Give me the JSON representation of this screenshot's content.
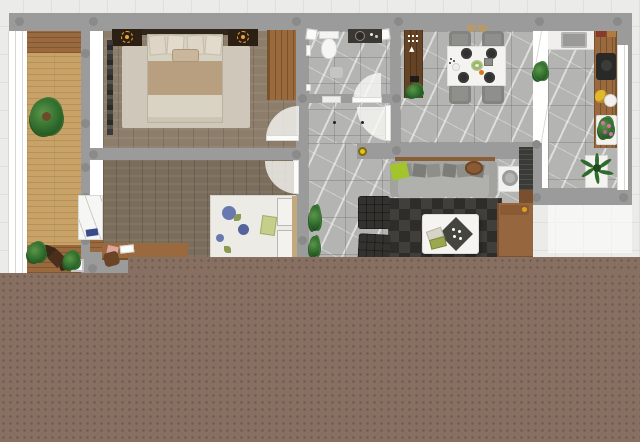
{
  "meta": {
    "title": "apartment-floor-plan-render",
    "view": "top-down 2.5D render on grid paper",
    "canvas": {
      "width": 640,
      "height": 442
    },
    "cutoff_band": "solid taupe band with dotted texture covering the lower part of the image, stepped edge at lower-left"
  },
  "colors": {
    "grid_bg": "#ebebe9",
    "grid_line": "#dfdfdd",
    "band": "#877062",
    "band_dot": "#6d594c",
    "wall": "#9b9b9b",
    "column": "#8a8a8a",
    "marble": "#b4b4b2",
    "marble_line": "#787876",
    "bedroom1_wood": "#8d7e6c",
    "bedroom2_wood": "#7b6d5b",
    "deck": "#c9a267",
    "deck_dark": "#9a6a3e",
    "closet_wood": "#654325",
    "counter_wood": "#9a6a3e",
    "wardrobe_wood": "#9a6a3c",
    "white": "#f4f3f0",
    "sofa": "#b0b0ac",
    "lime": "#a2c52e",
    "rug_dark": "#413f3b",
    "rug_dark2": "#2f2d29",
    "daybed": "#96663f",
    "lamp_glow": "#f0a030",
    "ceiling_light": "#e8c020",
    "plant_green": "#2f6b2c",
    "plant_light": "#5a9648",
    "flower_pink": "#d870a8",
    "fruit_yellow": "#e0b82a",
    "bed_cream": "#d6d2c2",
    "bed_tan": "#b89f7f",
    "floral_blue": "#6a78b0",
    "floral_leaf": "#8a9a55",
    "door_white": "#fbfbf9",
    "fixture_dark": "#3b3733",
    "cooktop": "#292927",
    "armchair": "#34322e",
    "table_gray": "#8f8f8b",
    "plate_dark": "#30302e",
    "headboard": "#32261a",
    "nightstand": "#2c2015"
  },
  "structure": {
    "walls": "gray with round structural columns",
    "columns_count": 21,
    "doors_with_swing_arcs": 4,
    "window_bands": [
      "west-facade-by-balcony",
      "east-facade-by-kitchen",
      "balcony-french-windows"
    ]
  },
  "rooms": [
    {
      "name": "balcony-terrace",
      "floor": "tan deck boards with dark wood ends",
      "furniture": [
        "large-potted-plant",
        "bistro-table",
        "two-bistro-chairs",
        "two-planter-pots",
        "white-tray"
      ]
    },
    {
      "name": "master-bedroom",
      "floor": "gray-brown plank wood",
      "furniture": [
        "double-bed-cream",
        "dark-headboard",
        "nightstand-left",
        "nightstand-right",
        "two-glowing-table-lamps",
        "light-area-rug",
        "wood-wardrobe",
        "tall-coat-rack"
      ]
    },
    {
      "name": "second-bedroom",
      "floor": "brown plank wood",
      "furniture": [
        "double-bed-floral-blue",
        "stacked-pillows",
        "green-cushion",
        "desk-with-papers",
        "desk-chair",
        "white-marble-cabinet",
        "blue-book"
      ]
    },
    {
      "name": "bathroom",
      "floor": "gray marble tile",
      "furniture": [
        "toilet",
        "dark-vanity-with-round-sink",
        "two-corner-shelves",
        "bath-mat",
        "towel-rails",
        "doormat"
      ]
    },
    {
      "name": "hallway",
      "floor": "gray marble tile",
      "furniture": [
        "two-ceiling-spotlights",
        "swing-door-to-bathroom",
        "swing-door-to-hall"
      ]
    },
    {
      "name": "entry-closet",
      "floor": "marble",
      "furniture": [
        "dark-wood-wardrobe-strip",
        "white-dot-shelf-icons",
        "hanger-icon",
        "dark-shoes",
        "potted-plant"
      ]
    },
    {
      "name": "dining-room",
      "floor": "gray marble tile",
      "furniture": [
        "white-dining-table",
        "four-gray-chairs",
        "four-dark-plates",
        "salad-bowl",
        "gray-box",
        "orange-fruit",
        "small-dishes",
        "two-pendant-lamps"
      ]
    },
    {
      "name": "kitchen",
      "floor": "gray marble tile",
      "furniture": [
        "white-sink-counter",
        "gray-sink",
        "wood-counter-run",
        "red-tray",
        "cutting-board",
        "black-cooktop",
        "banana-fruit",
        "white-fruit-bowl",
        "white-side-table",
        "pink-flower-plant",
        "palm-plant-in-white-pot"
      ]
    },
    {
      "name": "living-room",
      "floor": "gray marble tile",
      "furniture": [
        "gray-sofa",
        "six-back-pillows",
        "lime-green-pillow",
        "brown-serving-tray",
        "wall-console-shelf",
        "white-side-table-with-lamp-ring",
        "two-black-wicker-armchairs",
        "dark-checkered-rug",
        "white-coffee-table",
        "dark-diamond-tray",
        "two-books",
        "brown-daybed",
        "dark-media-shelf",
        "wall-plants"
      ]
    }
  ],
  "lights": {
    "yellow_ceiling_light": 1,
    "nightstand_lamps": 2,
    "hall_spotlights": 2
  }
}
